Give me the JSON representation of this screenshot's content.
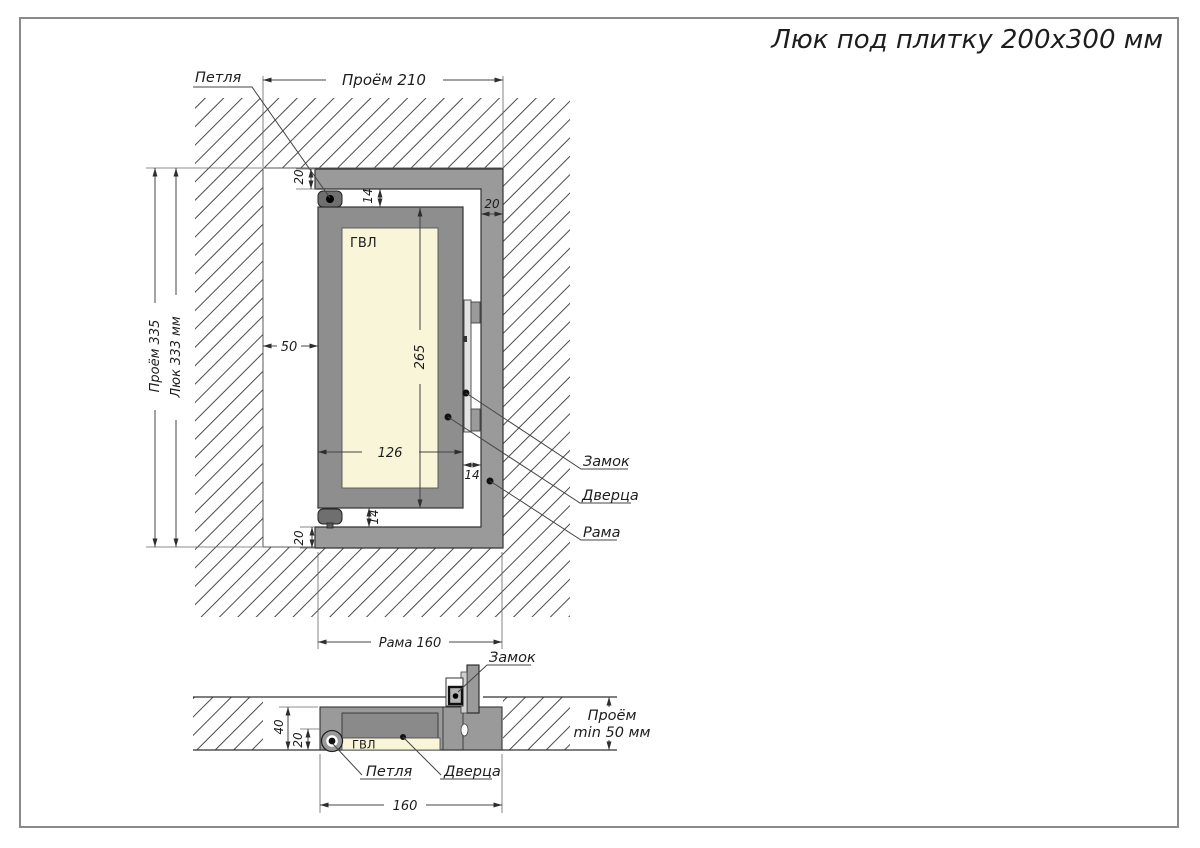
{
  "title": "Люк под плитку 200х300 мм",
  "plan": {
    "dim_opening_w": "Проём 210",
    "dim_opening_h": "Проём 335",
    "dim_hatch_h": "Люк 333 мм",
    "dim_top_profile": "20",
    "dim_top_gap": "14",
    "dim_right_profile": "20",
    "dim_left_offset": "50",
    "dim_door_h": "265",
    "dim_door_w": "126",
    "dim_bottom_gap": "14",
    "dim_right_gap": "14",
    "dim_bottom_profile": "20",
    "dim_frame_w": "Рама 160",
    "label_hinge": "Петля",
    "label_lock": "Замок",
    "label_door": "Дверца",
    "label_frame": "Рама",
    "label_gvl": "ГВЛ"
  },
  "section": {
    "dim_depth": "40",
    "dim_hinge_depth": "20",
    "dim_frame_w": "160",
    "dim_opening_l1": "Проём",
    "dim_opening_l2": "min 50 мм",
    "label_lock": "Замок",
    "label_hinge": "Петля",
    "label_door": "Дверца",
    "label_gvl": "ГВЛ"
  },
  "colors": {
    "frame_gray": "#9a9a9a",
    "door_gray": "#8e8e8e",
    "panel_cream": "#f8f5d8",
    "hinge_dark": "#6f6f6f",
    "line_dark": "#333333"
  }
}
